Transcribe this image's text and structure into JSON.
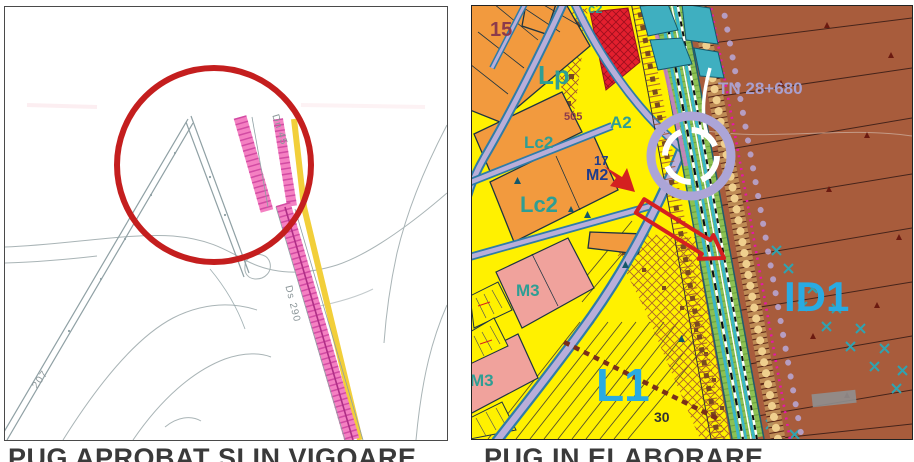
{
  "captions": {
    "left": "PUG APROBAT SI IN VIGOARE",
    "right": "PUG IN ELABORARE",
    "color": "#3a3a3a"
  },
  "left_map": {
    "description_labels": [
      {
        "text": "Dn 45"
      },
      {
        "text": "Ds 290"
      },
      {
        "text": "207"
      }
    ],
    "highlight_circle_color": "#c41e1e",
    "road_band_pink": "#f480c2",
    "road_band_yellow": "#f2cf3a",
    "linework_gray": "#8fa0a4"
  },
  "right_map": {
    "zone_labels": [
      {
        "text": "15",
        "color": "#8c3b4b"
      },
      {
        "text": "c2",
        "color": "#2e9e94"
      },
      {
        "text": "Lp",
        "color": "#2e9e94"
      },
      {
        "text": "505",
        "color": "#8c3b4b"
      },
      {
        "text": "Lc2",
        "color": "#2e9e94"
      },
      {
        "text": "Lc2",
        "color": "#2e9e94"
      },
      {
        "text": "A2",
        "color": "#2e9e94"
      },
      {
        "text": "17",
        "color": "#1f3c8c"
      },
      {
        "text": "M2",
        "color": "#1f3c8c"
      },
      {
        "text": "M3",
        "color": "#2e9e94"
      },
      {
        "text": "M3",
        "color": "#2e9e94"
      },
      {
        "text": "L1",
        "color": "#29abe2"
      },
      {
        "text": "30",
        "color": "#333333"
      },
      {
        "text": "ID1",
        "color": "#29abe2"
      },
      {
        "text": "TN 28+680",
        "color": "#a9a0ce"
      }
    ],
    "zone_colors": {
      "residential_yellow": "#fff100",
      "parcel_orange": "#f29a3e",
      "parcel_pink": "#f0a29c",
      "industrial_brown": "#a85c3c",
      "red_parcel": "#e31f2e",
      "street_lavender": "#b9aed9",
      "street_edge_teal": "#2f7ca8",
      "corridor_green": "#8cc153",
      "corridor_teal": "#3ab6c8",
      "dotted_magenta": "#e617a8"
    },
    "annotations": {
      "ring_outer_color": "#aca5d7",
      "ring_inner_color": "#ffffff",
      "arrow_color": "#d42020"
    }
  }
}
